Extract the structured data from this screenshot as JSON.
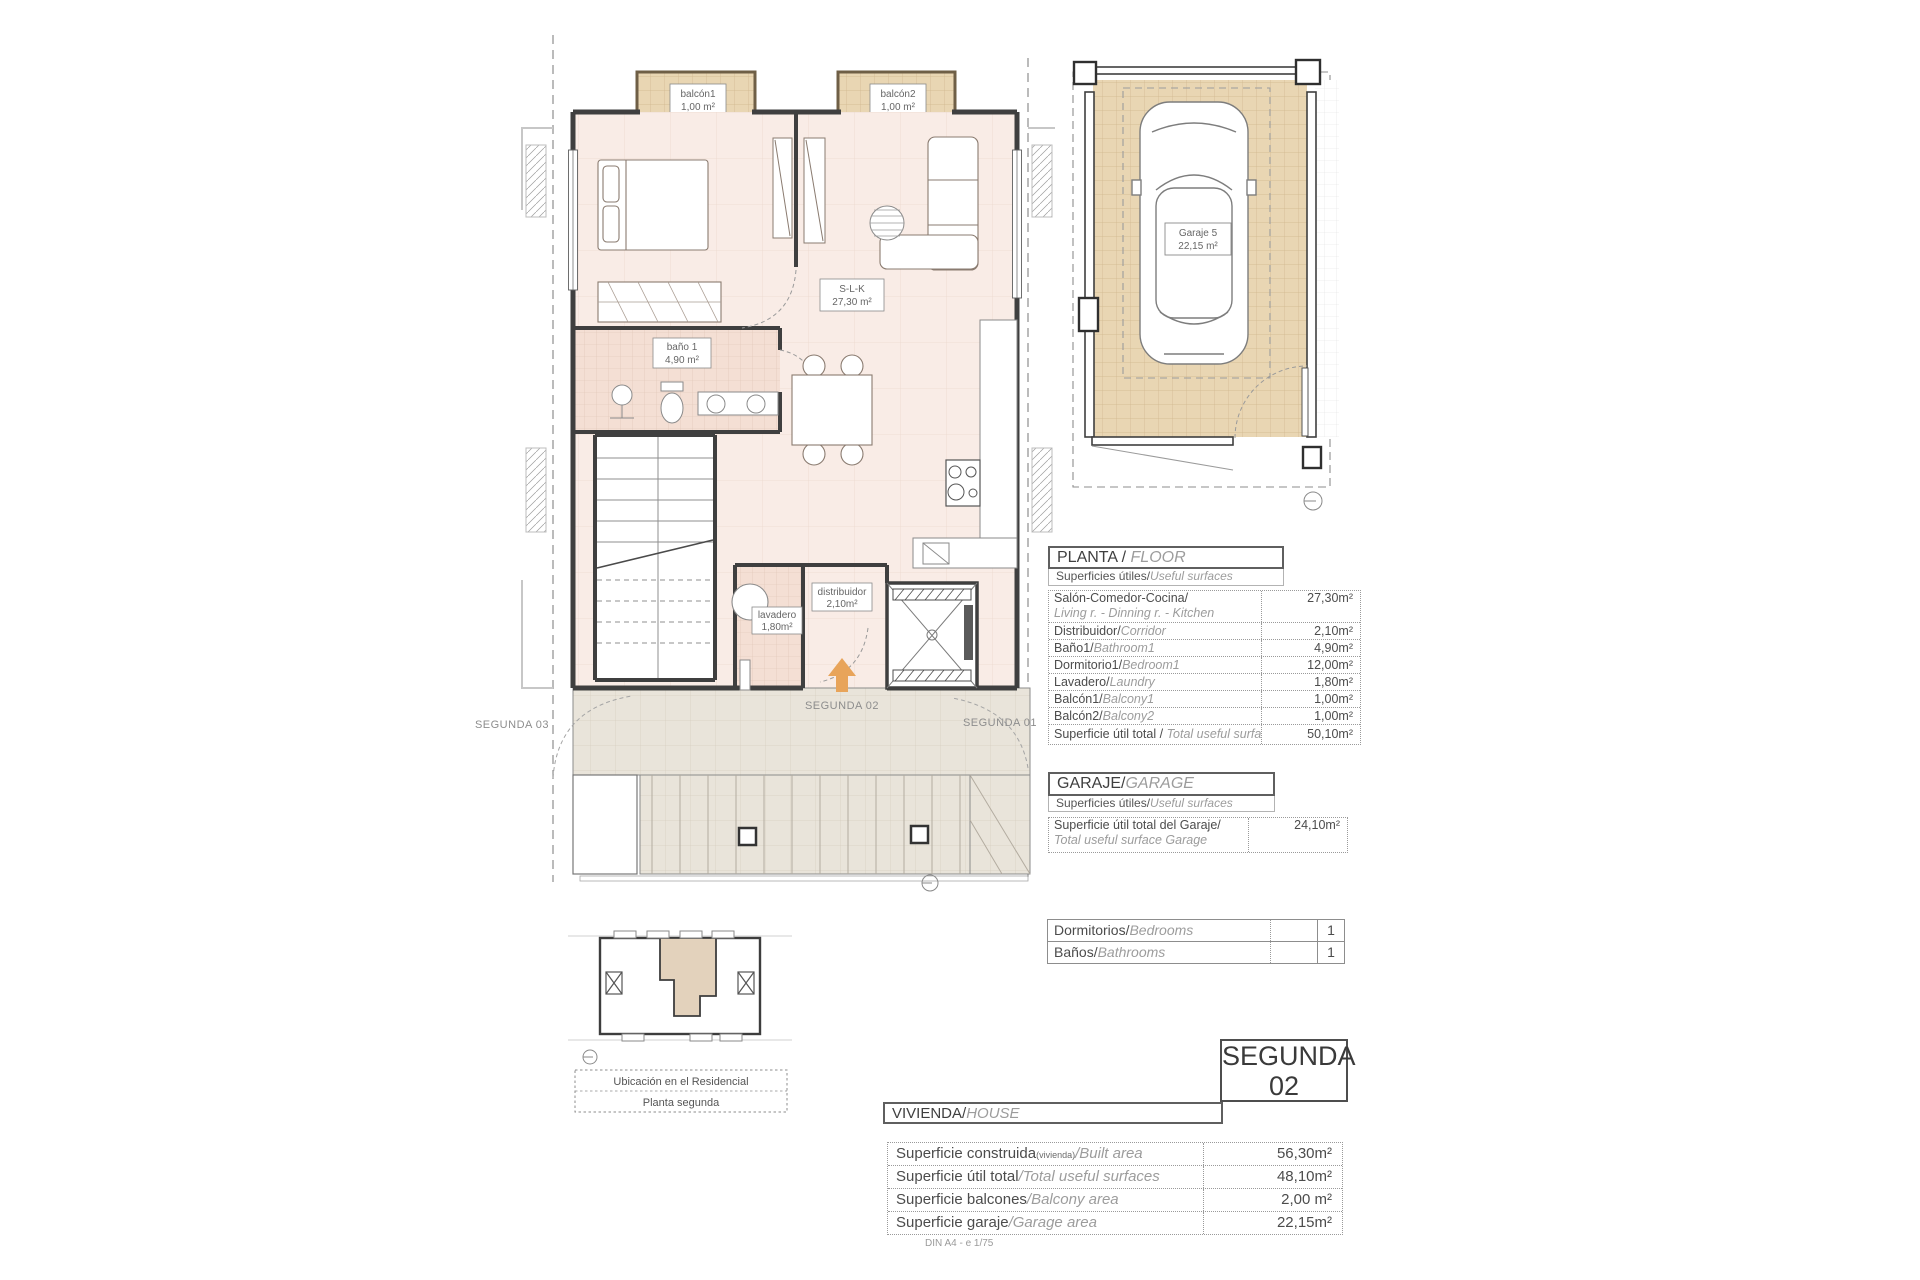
{
  "plan": {
    "balcony1": {
      "name": "balcón1",
      "area": "1,00 m²"
    },
    "balcony2": {
      "name": "balcón2",
      "area": "1,00 m²"
    },
    "slk": {
      "name": "S-L-K",
      "area": "27,30 m²"
    },
    "bath": {
      "name": "baño 1",
      "area": "4,90 m²"
    },
    "laundry": {
      "name": "lavadero",
      "area": "1,80m²"
    },
    "corridor": {
      "name": "distribuidor",
      "area": "2,10m²"
    },
    "unit_label": "SEGUNDA 02",
    "neighbor_left": "SEGUNDA 03",
    "neighbor_right": "SEGUNDA 01"
  },
  "garage_plan": {
    "label": {
      "name": "Garaje 5",
      "area": "22,15 m²"
    }
  },
  "location_plan": {
    "line1": "Ubicación en el Residencial",
    "line2": "Planta segunda"
  },
  "planta_table": {
    "title_es": "PLANTA / ",
    "title_en": "FLOOR",
    "subtitle_es": "Superficies útiles/",
    "subtitle_en": "Useful surfaces",
    "rows": [
      {
        "es": "Salón-Comedor-Cocina/",
        "en": "Living r. - Dinning r. - Kitchen",
        "value": "27,30m²"
      },
      {
        "es": "Distribuidor/",
        "en": "Corridor",
        "value": "2,10m²"
      },
      {
        "es": "Baño1/",
        "en": "Bathroom1",
        "value": "4,90m²"
      },
      {
        "es": "Dormitorio1/",
        "en": "Bedroom1",
        "value": "12,00m²"
      },
      {
        "es": "Lavadero/",
        "en": "Laundry",
        "value": "1,80m²"
      },
      {
        "es": "Balcón1/",
        "en": "Balcony1",
        "value": "1,00m²"
      },
      {
        "es": "Balcón2/",
        "en": "Balcony2",
        "value": "1,00m²"
      }
    ],
    "total": {
      "es": "Superficie útil total / ",
      "en": "Total useful surface",
      "value": "50,10m²"
    }
  },
  "garaje_table": {
    "title_es": "GARAJE/",
    "title_en": "GARAGE",
    "subtitle_es": "Superficies útiles/",
    "subtitle_en": "Useful surfaces",
    "row": {
      "es": "Superficie útil total del Garaje/",
      "en": "Total useful surface Garage",
      "value": "24,10m²"
    }
  },
  "counts_table": {
    "rows": [
      {
        "es": "Dormitorios/",
        "en": "Bedrooms",
        "value": "1"
      },
      {
        "es": "Baños/",
        "en": "Bathrooms",
        "value": "1"
      }
    ]
  },
  "unit_badge": {
    "line1": "SEGUNDA",
    "line2": "02"
  },
  "vivienda_table": {
    "title_es": "VIVIENDA/",
    "title_en": "HOUSE",
    "rows": [
      {
        "es": "Superficie construida",
        "sub": "(vivienda)",
        "en": "/Built area",
        "value": "56,30m²"
      },
      {
        "es": "Superficie útil total",
        "sub": "",
        "en": "/Total useful surfaces",
        "value": "48,10m²"
      },
      {
        "es": "Superficie balcones",
        "sub": "",
        "en": "/Balcony area",
        "value": "2,00 m²"
      },
      {
        "es": "Superficie garaje",
        "sub": "",
        "en": "/Garage area",
        "value": "22,15m²"
      }
    ],
    "caption": "DIN A4 - e 1/75"
  },
  "colors": {
    "wall": "#3f3f3f",
    "floor_pink": "#f9ece6",
    "tile_tan": "#e9d6b3",
    "tile_grey": "#e9e4da",
    "tile_bath": "#f4dfd4",
    "arrow_orange": "#e8a45a"
  }
}
